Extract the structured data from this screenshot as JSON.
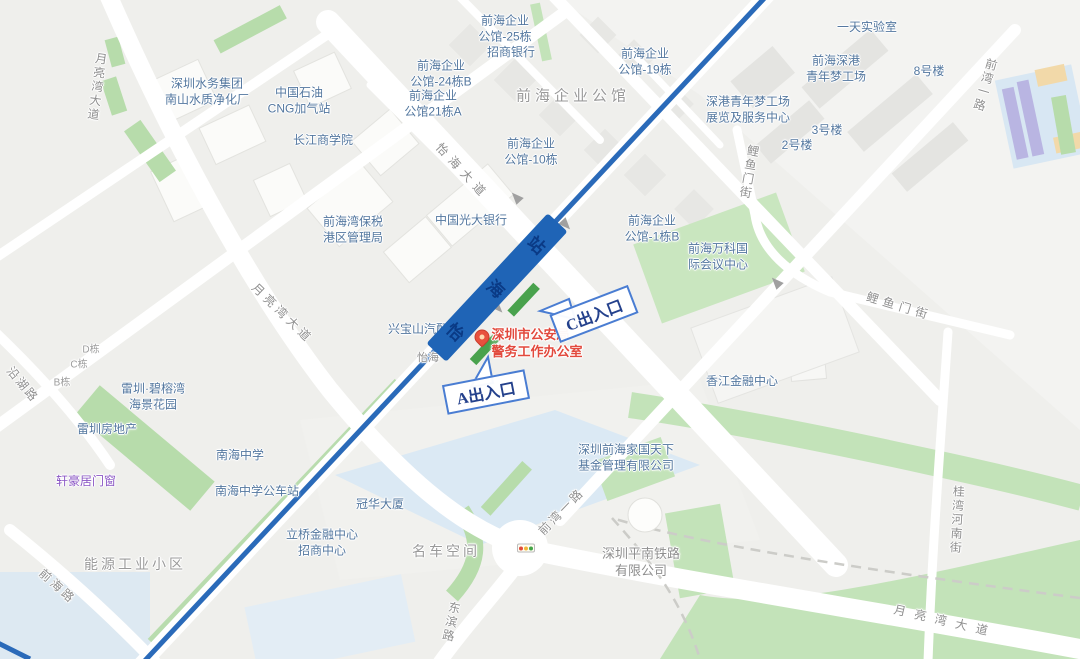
{
  "map_type": "street-map",
  "station": {
    "name": "怡海站",
    "exit_a_label": "A出入口",
    "exit_c_label": "C出入口"
  },
  "highlight_poi": {
    "line1": "深圳市公安局",
    "line2": "警务工作办公室"
  },
  "labels": {
    "waterworks": {
      "l1": "深圳水务集团",
      "l2": "南山水质净化厂"
    },
    "cnpc": {
      "l1": "中国石油",
      "l2": "CNG加气站"
    },
    "ckgsb": {
      "t": "长江商学院"
    },
    "gongguan25": {
      "l1": "前海企业",
      "l2": "公馆-25栋"
    },
    "cmb": {
      "t": "招商银行"
    },
    "gongguan24b": {
      "l1": "前海企业",
      "l2": "公馆-24栋B"
    },
    "gongguan21a": {
      "l1": "前海企业",
      "l2": "公馆21栋A"
    },
    "gongguan_main": {
      "t": "前海企业公馆"
    },
    "gongguan19": {
      "l1": "前海企业",
      "l2": "公馆-19栋"
    },
    "lab": {
      "t": "一天实验室"
    },
    "dream_factory": {
      "l1": "前海深港",
      "l2": "青年梦工场"
    },
    "bldg8": {
      "t": "8号楼"
    },
    "dream_exhibit": {
      "l1": "深港青年梦工场",
      "l2": "展览及服务中心"
    },
    "bldg3": {
      "t": "3号楼"
    },
    "bldg2": {
      "t": "2号楼"
    },
    "gongguan10": {
      "l1": "前海企业",
      "l2": "公馆-10栋"
    },
    "bonded": {
      "l1": "前海湾保税",
      "l2": "港区管理局"
    },
    "everbright": {
      "t": "中国光大银行"
    },
    "gongguan1b": {
      "l1": "前海企业",
      "l2": "公馆-1栋B"
    },
    "vanke": {
      "l1": "前海万科国",
      "l2": "际会议中心"
    },
    "xingbaoshan": {
      "t": "兴宝山汽配"
    },
    "dong_d": {
      "t": "D栋"
    },
    "dong_c": {
      "t": "C栋"
    },
    "dong_b": {
      "t": "B栋"
    },
    "leizhen_garden": {
      "l1": "雷圳·碧榕湾",
      "l2": "海景花园"
    },
    "leizhen_realty": {
      "t": "雷圳房地产"
    },
    "xuanhao": {
      "t": "轩豪居门窗"
    },
    "nanhai_school": {
      "t": "南海中学"
    },
    "nanhai_busstop": {
      "t": "南海中学公车站"
    },
    "guanhua": {
      "t": "冠华大厦"
    },
    "liqiao": {
      "l1": "立桥金融中心",
      "l2": "招商中心"
    },
    "mingche": {
      "t": "名车空间"
    },
    "energy": {
      "t": "能源工业小区"
    },
    "jiaguo": {
      "l1": "深圳前海家国天下",
      "l2": "基金管理有限公司"
    },
    "pingnan": {
      "l1": "深圳平南铁路",
      "l2": "有限公司"
    },
    "xiangjiang": {
      "t": "香江金融中心"
    },
    "yihai_frag": {
      "t": "怡海"
    }
  },
  "roads": {
    "yihai_ave": "怡海大道",
    "moonbay": "月亮湾大道",
    "qianwan_yilu": "前湾一路",
    "liyumen": "鲤鱼门街",
    "guiwan_henan": "桂湾河南街",
    "dongbin": "东滨路",
    "qianhai_rd": "前海路",
    "yanhu_rd": "沿湖路"
  },
  "colors": {
    "metro_line": "#2a6ab9",
    "station_fill": "#1f64b6",
    "exit_green": "#49a24d",
    "callout_border": "#4a7dd2",
    "poi_red": "#e2493d",
    "label_blue": "#53779f",
    "road_label_gray": "#8f8f8f",
    "park_green": "#c3e3b9",
    "school_blue": "#dbe9f4"
  }
}
